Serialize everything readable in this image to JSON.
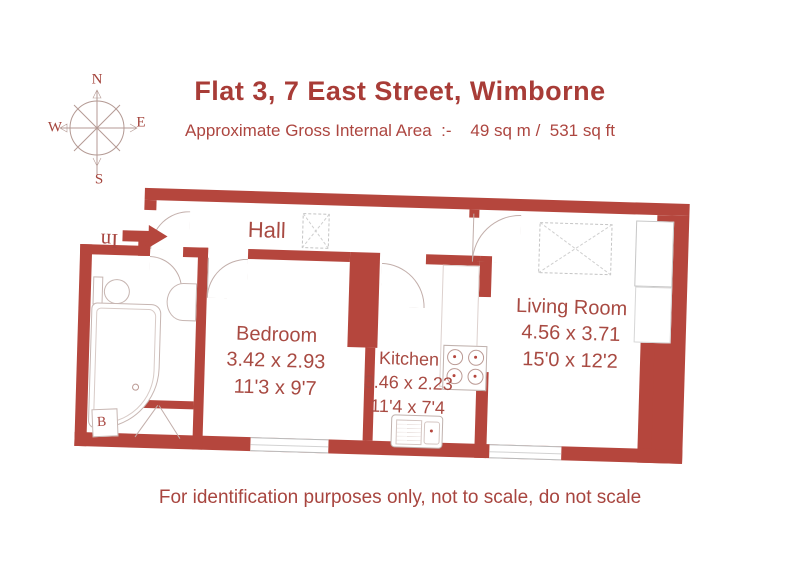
{
  "header": {
    "title": "Flat 3, 7 East Street, Wimborne",
    "subtitle": "Approximate Gross Internal Area  :-    49 sq m /  531 sq ft"
  },
  "compass": {
    "north": "N",
    "east": "E",
    "south": "S",
    "west": "W"
  },
  "entrance": {
    "label": "In"
  },
  "rooms": {
    "hall": {
      "name": "Hall"
    },
    "bedroom": {
      "name": "Bedroom",
      "metric": "3.42 x 2.93",
      "imperial": "11'3 x 9'7"
    },
    "kitchen": {
      "name": "Kitchen",
      "metric": "3.46 x 2.23",
      "imperial": "11'4 x 7'4"
    },
    "living_room": {
      "name": "Living Room",
      "metric": "4.56 x 3.71",
      "imperial": "15'0 x 12'2"
    }
  },
  "fixtures": {
    "boiler_label": "B"
  },
  "footer": {
    "disclaimer": "For identification purposes only, not to scale, do not scale"
  },
  "colors": {
    "wall": "#b5463d",
    "text": "#a8453f"
  }
}
